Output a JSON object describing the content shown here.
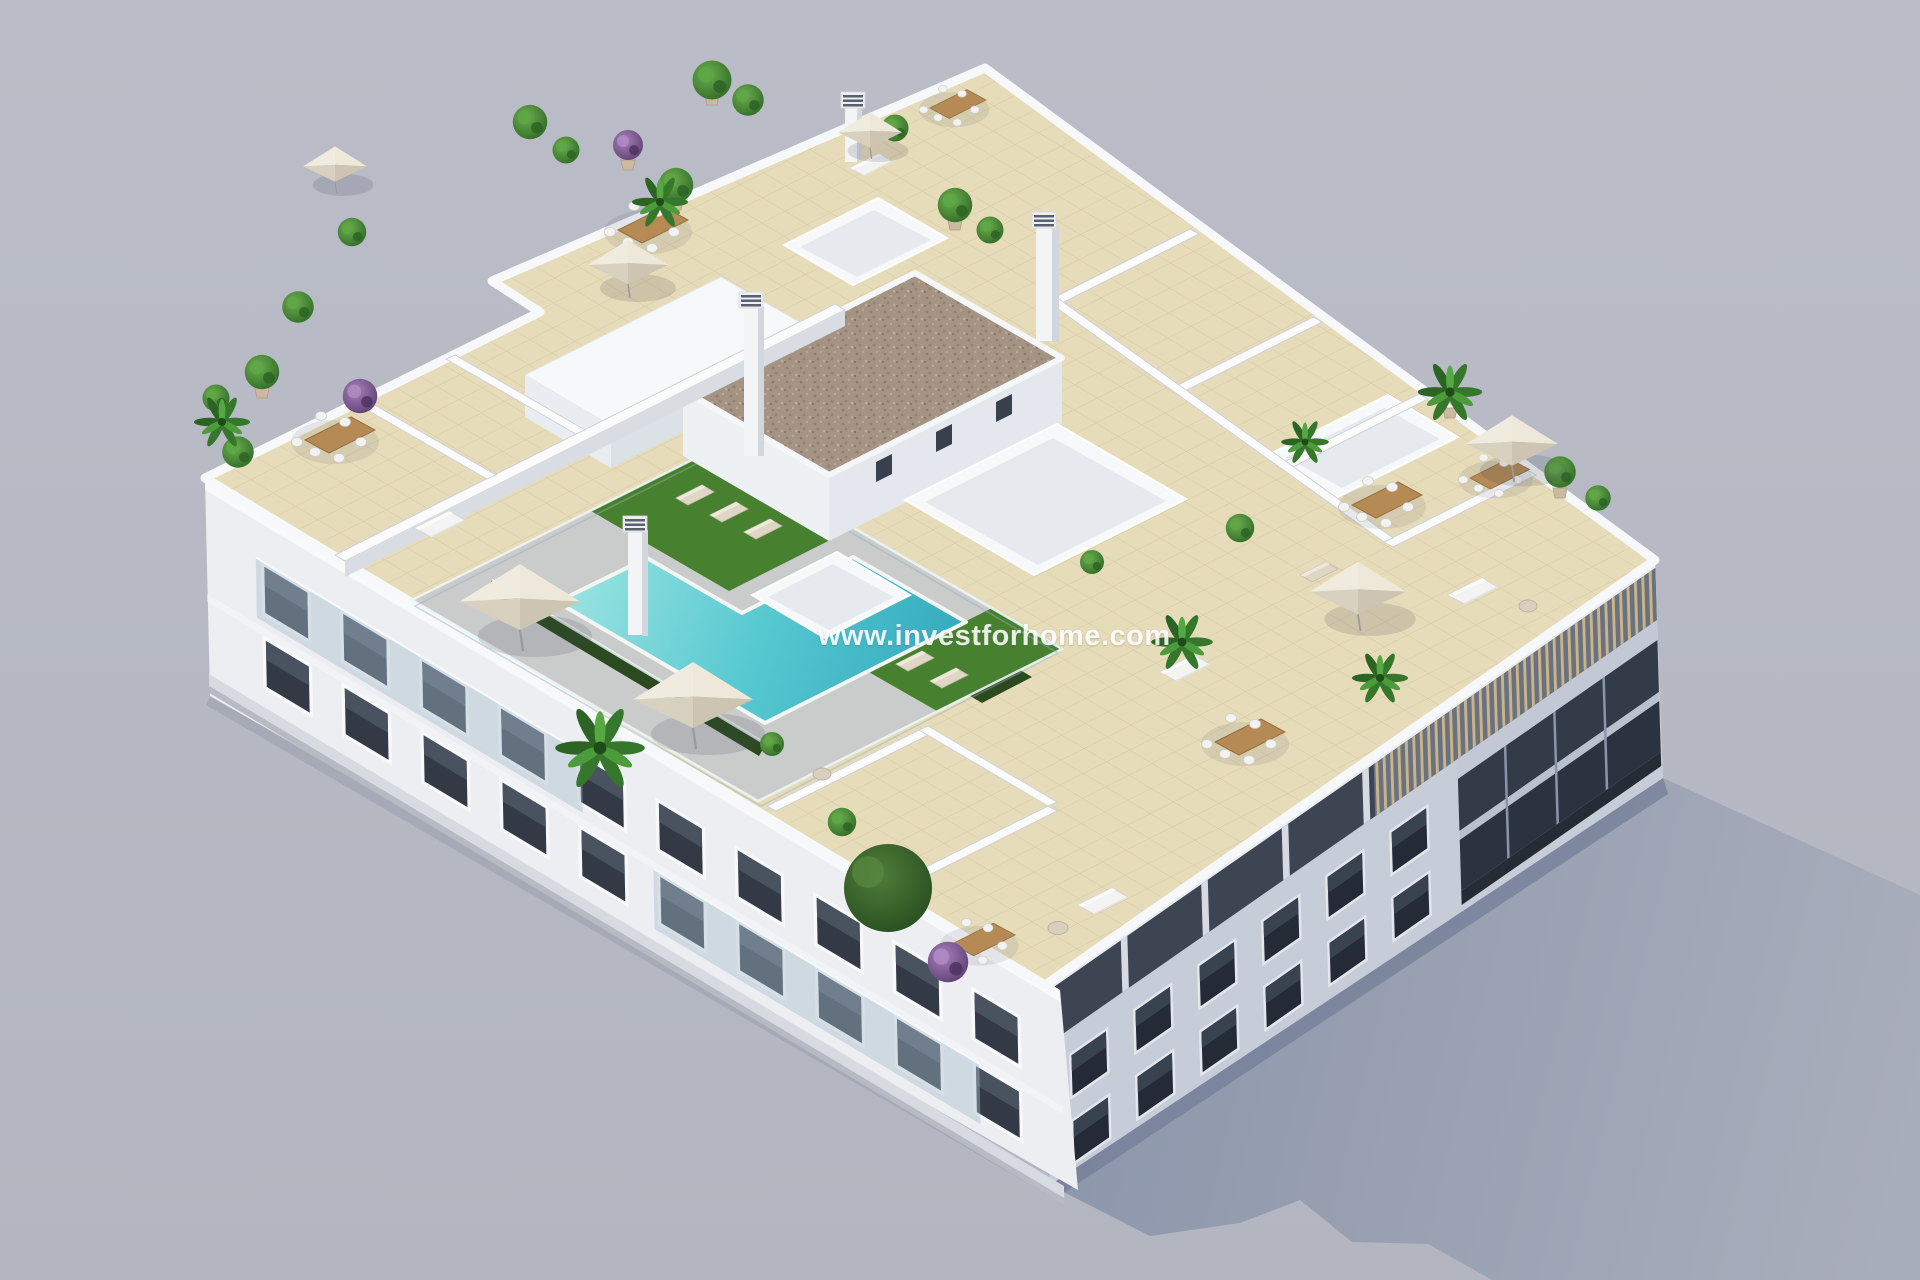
{
  "scene": {
    "description": "Aerial 3D architectural render of a white apartment building rooftop with communal swimming pool, sun terraces, parasols, sun loungers and potted plants",
    "background_color": "#b7bac4"
  },
  "watermark": {
    "text": "www.investforhome.com",
    "color": "#ffffff"
  },
  "colors": {
    "background": "#b7bac4",
    "ground-shadow-near": "#8b95aa",
    "ground-shadow-far": "#a8adbb",
    "parapet-white": "#f7f8fa",
    "facade-southwest": "#eceef1",
    "facade-southeast": "#c7cdd8",
    "window-glass": "#333a45",
    "balcony-glass": "#a8bccc",
    "balcony-recess": "#3d4452",
    "pergola-wood": "#c9b488",
    "roof-tile": "#e7dcb9",
    "tile-joint": "#cfc19b",
    "pool-deck": "#cacbcb",
    "pool-water-shallow": "#9fe5e2",
    "pool-water-deep": "#2fa6bb",
    "lawn-green": "#47812f",
    "hedge-green": "#2c4a20",
    "gravel-roof": "#a59384",
    "parasol-canopy": "#ddd6c6",
    "wood-furniture": "#b58a55",
    "plant-green": "#3f8f33",
    "plant-purple": "#8a63a0"
  }
}
